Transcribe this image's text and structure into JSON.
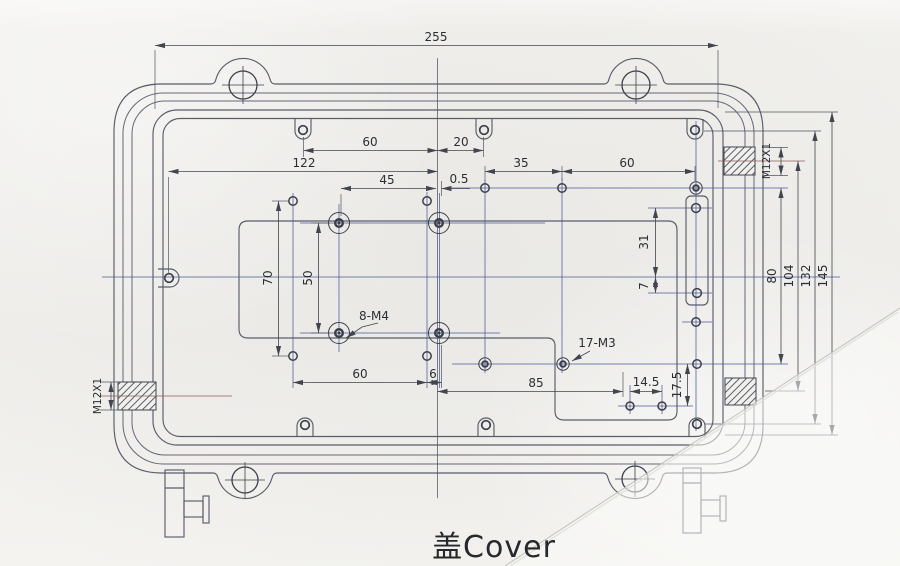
{
  "title": {
    "label": "盖Cover"
  },
  "dims": {
    "total_width": "255",
    "top_60": "60",
    "top_20": "20",
    "left_122": "122",
    "mid_35": "35",
    "right_60": "60",
    "mid_45": "45",
    "offset_05": "0.5",
    "vert_70": "70",
    "vert_50": "50",
    "callout_8m4": "8-M4",
    "vert_31": "31",
    "vert_7": "7",
    "callout_17m3": "17-M3",
    "bot_85": "85",
    "bot_145": "14.5",
    "vert_175": "17.5",
    "bot_60": "60",
    "bot_6": "6",
    "r_80": "80",
    "r_104": "104",
    "r_132": "132",
    "r_145": "145",
    "thread_left": "M12X1",
    "thread_right": "M12X1"
  },
  "colors": {
    "paper": "#f1f0ed",
    "outline": "#585d68",
    "centerline": "#4b5a94",
    "dimension": "#42454e",
    "text": "#2b2e33"
  }
}
